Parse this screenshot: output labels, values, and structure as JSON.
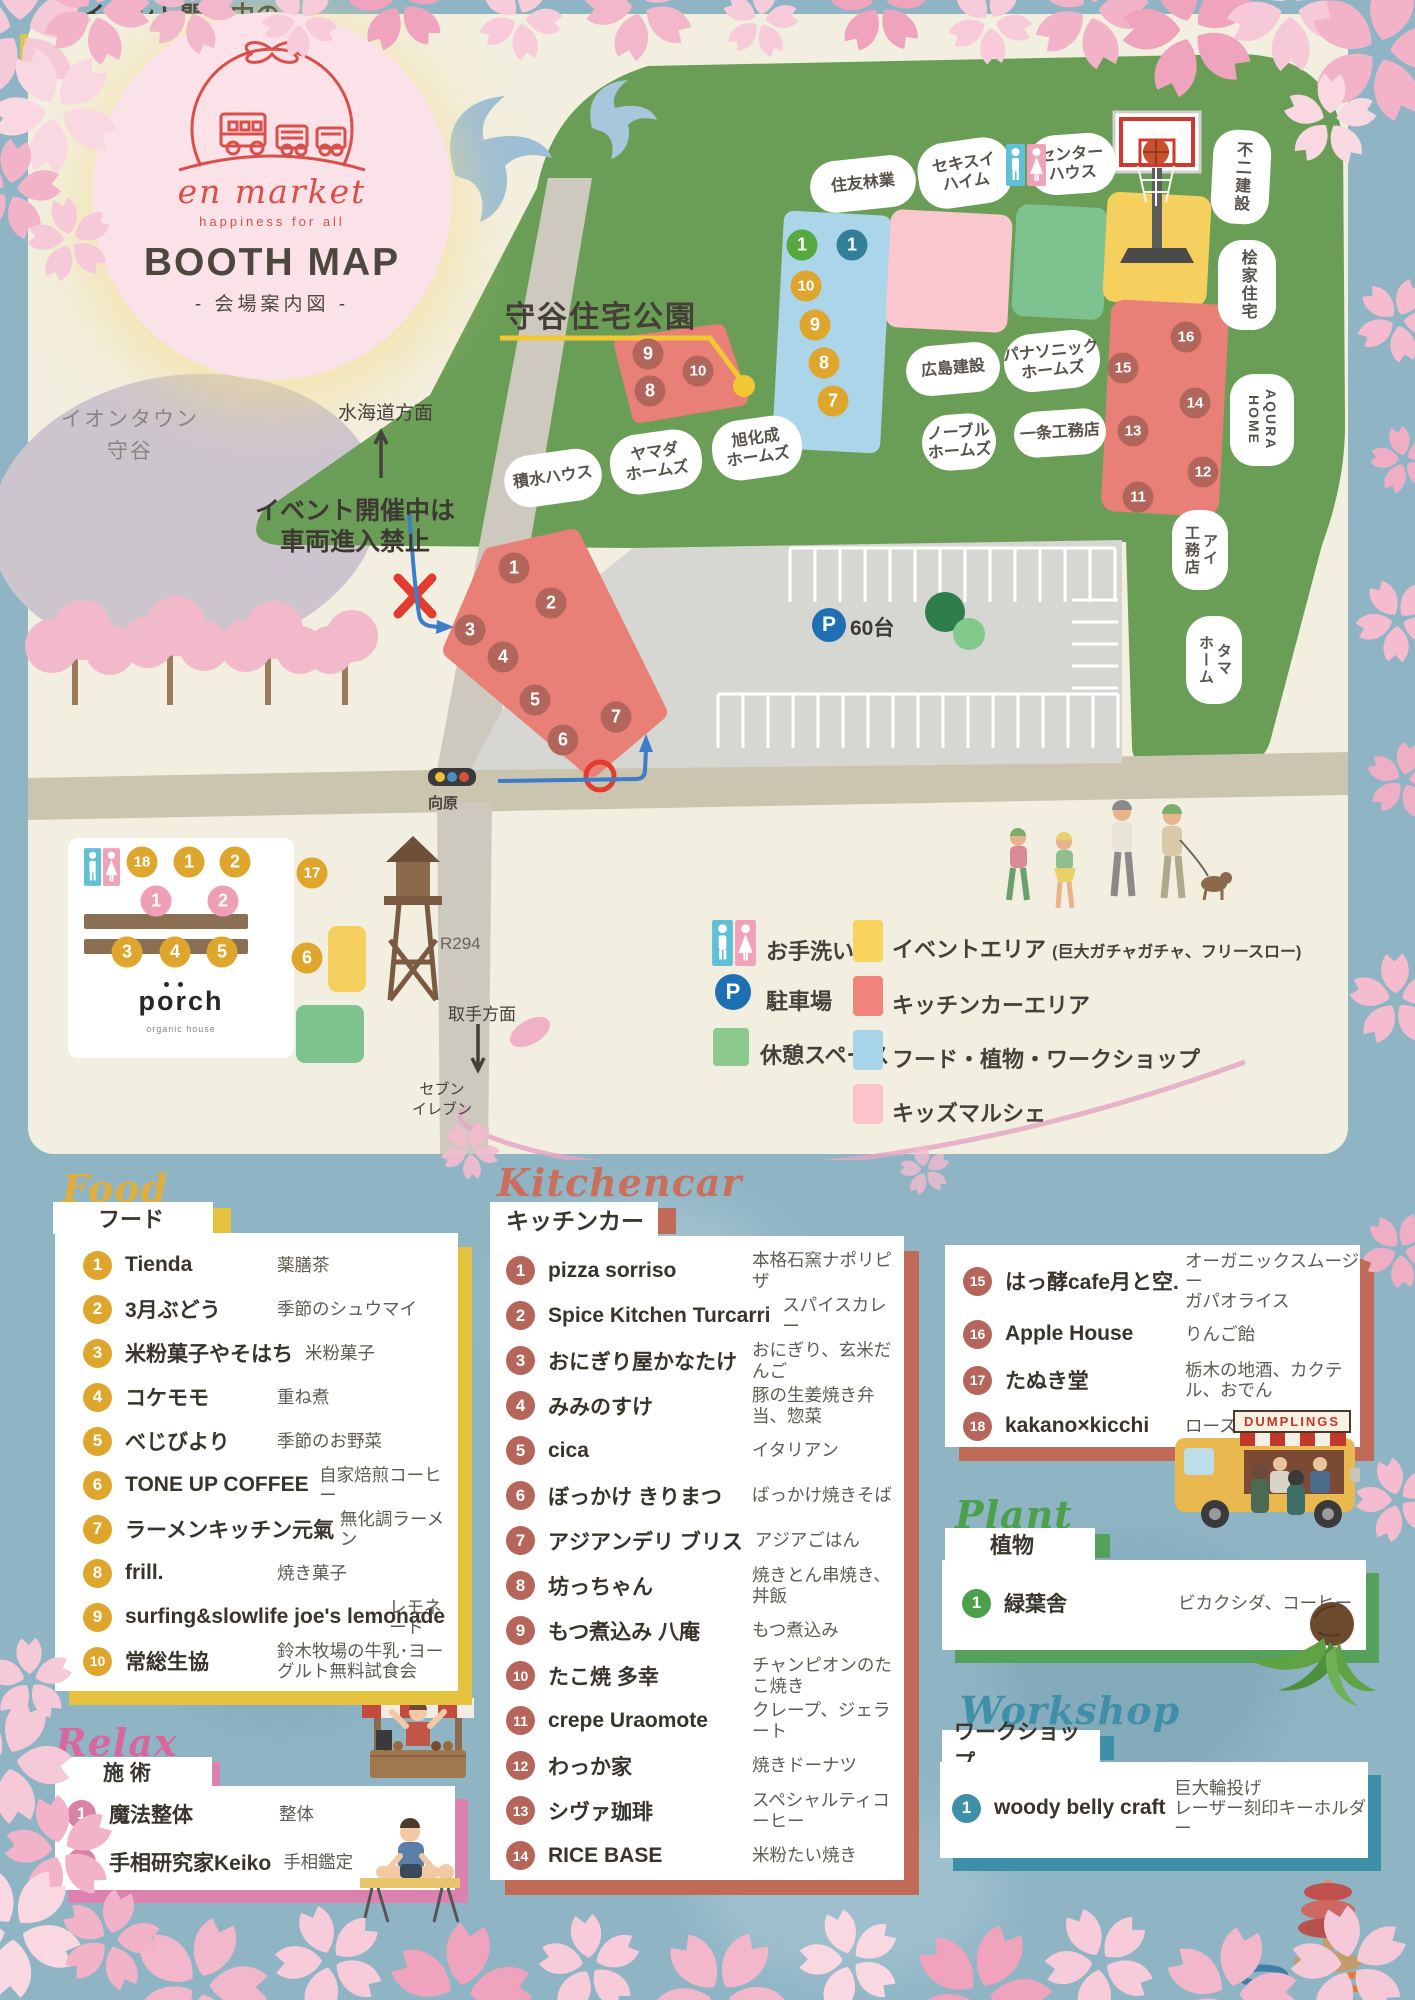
{
  "logo": {
    "brand": "en market",
    "tagline": "happiness for all",
    "title": "BOOTH MAP",
    "subtitle": "- 会場案内図 -"
  },
  "map": {
    "park_label": "守谷住宅公園",
    "labels": {
      "north": "水海道方面",
      "south": "取手方面",
      "route": "R294",
      "crossing": "向原",
      "seven": "セブン\nイレブン",
      "mall": "イオンタウン\n守谷",
      "parking_p": "P",
      "parking_count": "60台"
    },
    "notices": {
      "no_entry": "イベント開催中は\n車両進入禁止",
      "entrance_1": "イベント開催中の",
      "entrance_2": "車両出入り口はこちらから"
    },
    "bubbles": [
      {
        "text": "住友林業"
      },
      {
        "text": "セキスイ\nハイム"
      },
      {
        "text": "センター\nハウス"
      },
      {
        "text": "不二建設"
      },
      {
        "text": "桧家住宅"
      },
      {
        "text": "広島建設"
      },
      {
        "text": "パナソニック\nホームズ"
      },
      {
        "text": "一条工務店"
      },
      {
        "text": "ノーブル\nホームズ"
      },
      {
        "text": "積水ハウス"
      },
      {
        "text": "ヤマダ\nホームズ"
      },
      {
        "text": "旭化成\nホームズ"
      },
      {
        "text": "AQURA\nHOME"
      },
      {
        "text": "アイ\n工務店"
      },
      {
        "text": "タマ\nホーム"
      }
    ],
    "markers": [
      {
        "n": "1",
        "zone": "green",
        "x": 802,
        "y": 245
      },
      {
        "n": "1",
        "zone": "teal",
        "x": 852,
        "y": 245
      },
      {
        "n": "10",
        "zone": "yellow",
        "x": 806,
        "y": 286
      },
      {
        "n": "9",
        "zone": "yellow",
        "x": 815,
        "y": 325
      },
      {
        "n": "8",
        "zone": "yellow",
        "x": 824,
        "y": 363
      },
      {
        "n": "7",
        "zone": "yellow",
        "x": 833,
        "y": 401
      },
      {
        "n": "9",
        "zone": "red",
        "x": 648,
        "y": 354
      },
      {
        "n": "8",
        "zone": "red",
        "x": 650,
        "y": 391
      },
      {
        "n": "10",
        "zone": "red",
        "x": 698,
        "y": 371
      },
      {
        "n": "16",
        "zone": "red",
        "x": 1186,
        "y": 337
      },
      {
        "n": "15",
        "zone": "red",
        "x": 1123,
        "y": 368
      },
      {
        "n": "14",
        "zone": "red",
        "x": 1195,
        "y": 403
      },
      {
        "n": "13",
        "zone": "red",
        "x": 1133,
        "y": 431
      },
      {
        "n": "12",
        "zone": "red",
        "x": 1203,
        "y": 472
      },
      {
        "n": "11",
        "zone": "red",
        "x": 1138,
        "y": 497
      },
      {
        "n": "1",
        "zone": "red",
        "x": 514,
        "y": 568
      },
      {
        "n": "2",
        "zone": "red",
        "x": 551,
        "y": 603
      },
      {
        "n": "3",
        "zone": "red",
        "x": 470,
        "y": 630
      },
      {
        "n": "4",
        "zone": "red",
        "x": 503,
        "y": 657
      },
      {
        "n": "5",
        "zone": "red",
        "x": 535,
        "y": 700
      },
      {
        "n": "6",
        "zone": "red",
        "x": 563,
        "y": 740
      },
      {
        "n": "7",
        "zone": "red",
        "x": 616,
        "y": 717
      },
      {
        "n": "18",
        "zone": "yellow",
        "x": 142,
        "y": 862
      },
      {
        "n": "1",
        "zone": "yellow",
        "x": 189,
        "y": 862
      },
      {
        "n": "2",
        "zone": "yellow",
        "x": 235,
        "y": 862
      },
      {
        "n": "1",
        "zone": "pink",
        "x": 156,
        "y": 901
      },
      {
        "n": "2",
        "zone": "pink",
        "x": 223,
        "y": 901
      },
      {
        "n": "3",
        "zone": "yellow",
        "x": 127,
        "y": 952
      },
      {
        "n": "4",
        "zone": "yellow",
        "x": 175,
        "y": 952
      },
      {
        "n": "5",
        "zone": "yellow",
        "x": 222,
        "y": 952
      },
      {
        "n": "17",
        "zone": "yellow",
        "x": 312,
        "y": 873
      },
      {
        "n": "6",
        "zone": "yellow",
        "x": 307,
        "y": 958
      }
    ],
    "porch": {
      "logo": "porch",
      "sub": "organic house"
    }
  },
  "legend": {
    "left": [
      {
        "type": "toilet",
        "label": "お手洗い"
      },
      {
        "type": "parking",
        "label": "駐車場"
      },
      {
        "type": "rest",
        "label": "休憩スペース"
      }
    ],
    "right": [
      {
        "label": "イベントエリア",
        "note": "(巨大ガチャガチャ、フリースロー)",
        "color": "#F8D45F"
      },
      {
        "label": "キッチンカーエリア",
        "note": "",
        "color": "#F0837B"
      },
      {
        "label": "フード・植物・ワークショップ",
        "note": "",
        "color": "#A8D4EA"
      },
      {
        "label": "キッズマルシェ",
        "note": "",
        "color": "#FAC4CA"
      }
    ]
  },
  "sections": {
    "food": {
      "script": "Food",
      "title": "フード",
      "items": [
        {
          "n": "1",
          "name": "Tienda",
          "desc": "薬膳茶"
        },
        {
          "n": "2",
          "name": "3月ぶどう",
          "desc": "季節のシュウマイ"
        },
        {
          "n": "3",
          "name": "米粉菓子やそはち",
          "desc": "米粉菓子"
        },
        {
          "n": "4",
          "name": "コケモモ",
          "desc": "重ね煮"
        },
        {
          "n": "5",
          "name": "べじびより",
          "desc": "季節のお野菜"
        },
        {
          "n": "6",
          "name": "TONE UP COFFEE",
          "desc": "自家焙煎コーヒー"
        },
        {
          "n": "7",
          "name": "ラーメンキッチン元氣",
          "desc": "無化調ラーメン"
        },
        {
          "n": "8",
          "name": "frill.",
          "desc": "焼き菓子"
        },
        {
          "n": "9",
          "name": "surfing&slowlife joe's lemonade",
          "desc": "レモネード"
        },
        {
          "n": "10",
          "name": "常総生協",
          "desc": "鈴木牧場の牛乳･ヨーグルト無料試食会"
        }
      ]
    },
    "kitchencar": {
      "script": "Kitchencar",
      "title": "キッチンカー",
      "truck_sign": "DUMPLINGS",
      "items": [
        {
          "n": "1",
          "name": "pizza sorriso",
          "desc": "本格石窯ナポリピザ"
        },
        {
          "n": "2",
          "name": "Spice Kitchen Turcarri",
          "desc": "スパイスカレー"
        },
        {
          "n": "3",
          "name": "おにぎり屋かなたけ",
          "desc": "おにぎり、玄米だんご"
        },
        {
          "n": "4",
          "name": "みみのすけ",
          "desc": "豚の生姜焼き弁当、惣菜"
        },
        {
          "n": "5",
          "name": "cica",
          "desc": "イタリアン"
        },
        {
          "n": "6",
          "name": "ぼっかけ きりまつ",
          "desc": "ばっかけ焼きそば"
        },
        {
          "n": "7",
          "name": "アジアンデリ ブリス",
          "desc": "アジアごはん"
        },
        {
          "n": "8",
          "name": "坊っちゃん",
          "desc": "焼きとん串焼き、丼飯"
        },
        {
          "n": "9",
          "name": "もつ煮込み 八庵",
          "desc": "もつ煮込み"
        },
        {
          "n": "10",
          "name": "たこ焼 多幸",
          "desc": "チャンピオンのたこ焼き"
        },
        {
          "n": "11",
          "name": "crepe Uraomote",
          "desc": "クレープ、ジェラート"
        },
        {
          "n": "12",
          "name": "わっか家",
          "desc": "焼きドーナツ"
        },
        {
          "n": "13",
          "name": "シヴァ珈琲",
          "desc": "スペシャルティコーヒー"
        },
        {
          "n": "14",
          "name": "RICE BASE",
          "desc": "米粉たい焼き"
        }
      ],
      "items2": [
        {
          "n": "15",
          "name": "はっ酵cafe月と空.",
          "desc": "オーガニックスムージー\nガパオライス"
        },
        {
          "n": "16",
          "name": "Apple House",
          "desc": "りんご飴"
        },
        {
          "n": "17",
          "name": "たぬき堂",
          "desc": "栃木の地酒、カクテル、おでん"
        },
        {
          "n": "18",
          "name": "kakano×kicchi",
          "desc": "ロースイーツ"
        }
      ]
    },
    "plant": {
      "script": "Plant",
      "title": "植物",
      "items": [
        {
          "n": "1",
          "name": "緑葉舎",
          "desc": "ビカクシダ、コーヒー"
        }
      ]
    },
    "workshop": {
      "script": "Workshop",
      "title": "ワークショップ",
      "items": [
        {
          "n": "1",
          "name": "woody belly craft",
          "desc": "巨大輪投げ\nレーザー刻印キーホルダー"
        }
      ]
    },
    "relax": {
      "script": "Relax",
      "title": "施 術",
      "items": [
        {
          "n": "1",
          "name": "魔法整体",
          "desc": "整体"
        },
        {
          "n": "2",
          "name": "手相研究家Keiko",
          "desc": "手相鑑定"
        }
      ]
    }
  }
}
